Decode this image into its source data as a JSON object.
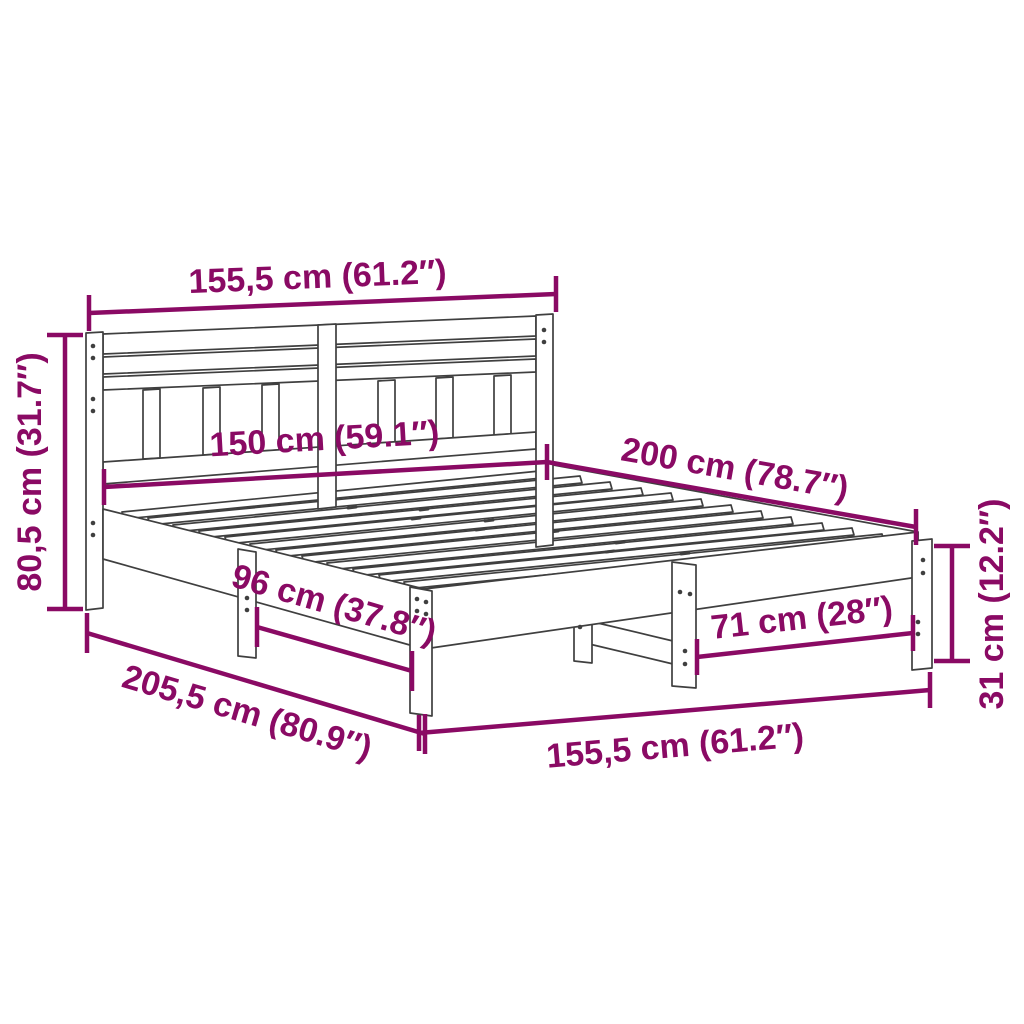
{
  "diagram": {
    "kind": "bed-frame-dimension-diagram",
    "colors": {
      "dimension_accent": "#8A0A64",
      "drawing_outline": "#3F3F3F",
      "background": "#FFFFFF"
    },
    "dimensions": [
      {
        "id": "headboard-width",
        "label": "155,5 cm (61.2″)"
      },
      {
        "id": "headboard-height",
        "label": "80,5 cm (31.7″)"
      },
      {
        "id": "slat-area-width",
        "label": "150 cm (59.1″)"
      },
      {
        "id": "bed-length",
        "label": "200 cm (78.7″)"
      },
      {
        "id": "side-leg-spacing",
        "label": "96 cm (37.8″)"
      },
      {
        "id": "total-length",
        "label": "205,5 cm (80.9″)"
      },
      {
        "id": "foot-leg-spacing",
        "label": "71 cm (28″)"
      },
      {
        "id": "bed-width",
        "label": "155,5 cm (61.2″)"
      },
      {
        "id": "leg-height",
        "label": "31 cm (12.2″)"
      }
    ]
  }
}
